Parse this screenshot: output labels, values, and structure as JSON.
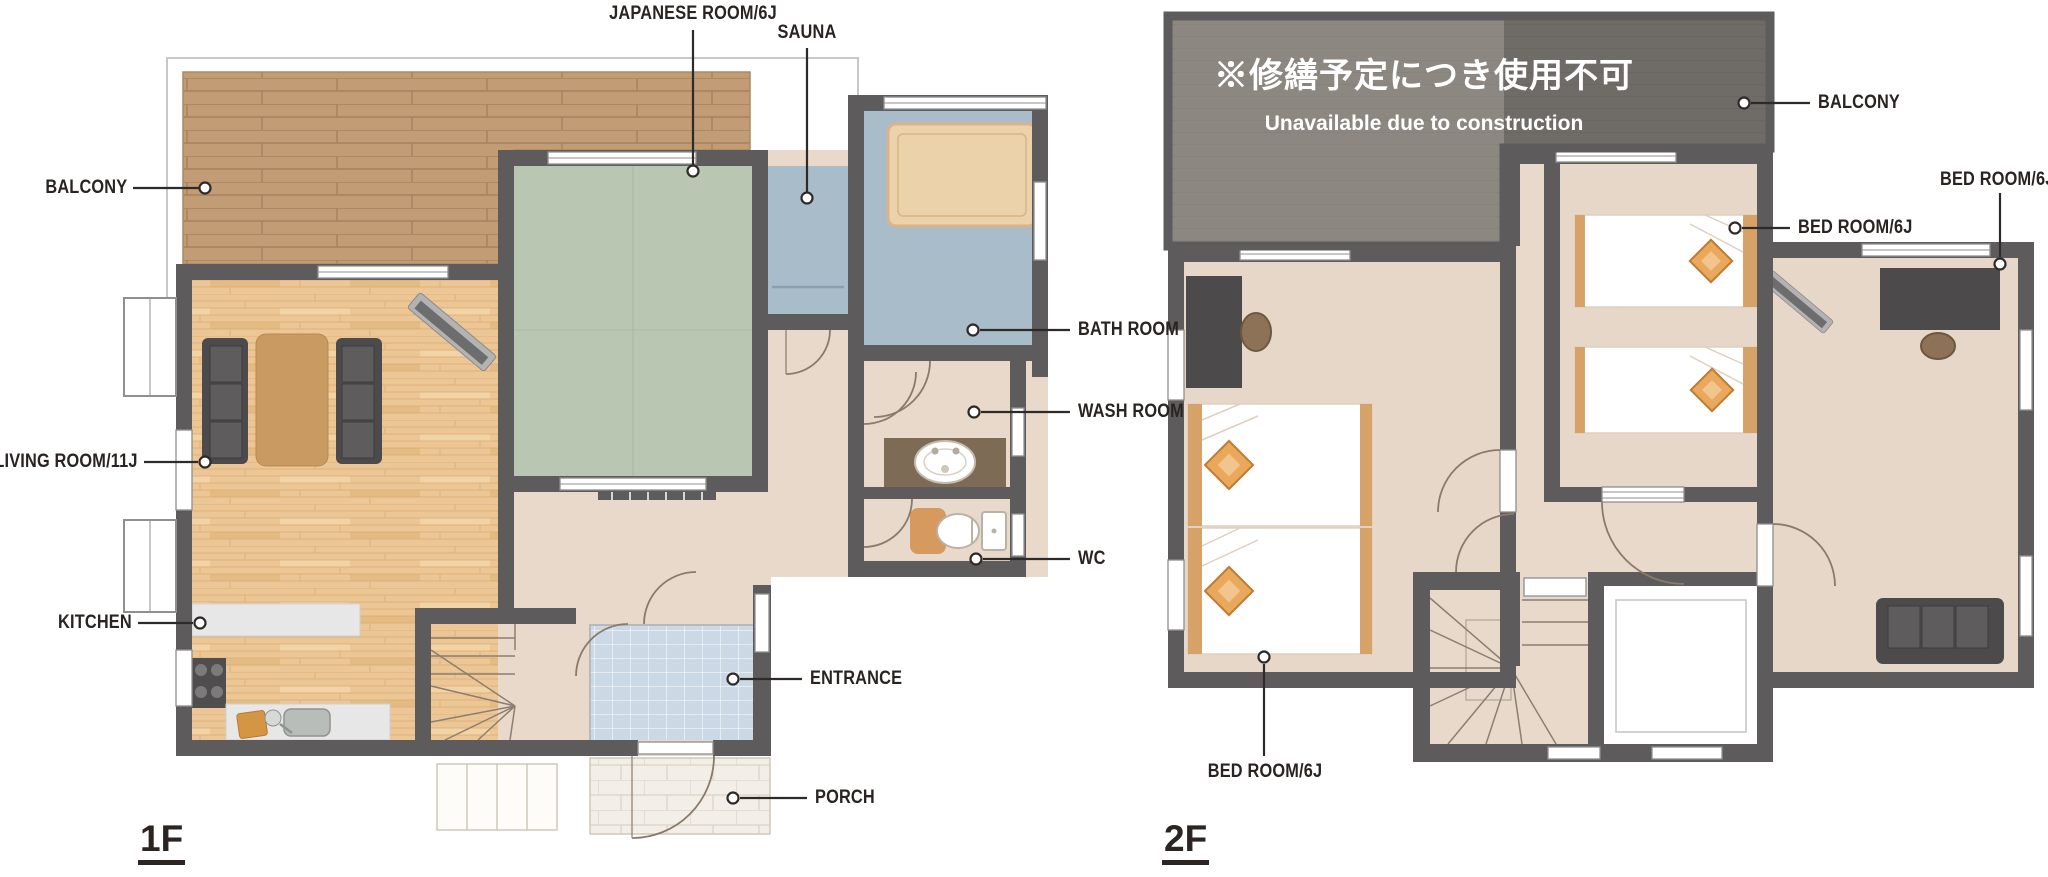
{
  "floor1": {
    "name": "1F",
    "labels": {
      "balcony": "BALCONY",
      "japanese_room": "JAPANESE ROOM/6J",
      "sauna": "SAUNA",
      "living_room": "LIVING ROOM/11J",
      "kitchen": "KITCHEN",
      "bath_room": "BATH ROOM",
      "wash_room": "WASH ROOM",
      "wc": "WC",
      "entrance": "ENTRANCE",
      "porch": "PORCH"
    }
  },
  "floor2": {
    "name": "2F",
    "notice_jp": "※修繕予定につき使用不可",
    "notice_en": "Unavailable due to construction",
    "labels": {
      "balcony": "BALCONY",
      "bedroom_right": "BED ROOM/6J",
      "bedroom_middle": "BED ROOM/6J",
      "bedroom_left": "BED ROOM/6J"
    }
  },
  "palette": {
    "wall": "#5d5b5b",
    "wood_floor": "#ecc795",
    "deck": "#c29c75",
    "tatami": "#b9c6b2",
    "wet_room": "#a9bcca",
    "hall_floor": "#e9d9ca",
    "room_floor_2f": "#e7d7c8",
    "tile_entrance": "#cbd8e6",
    "porch": "#f3efe8",
    "balcony_overlay": "#8c8781",
    "balcony_dark": "#6f6b67",
    "accent_orange": "#e2974d",
    "label_text": "#292422"
  }
}
